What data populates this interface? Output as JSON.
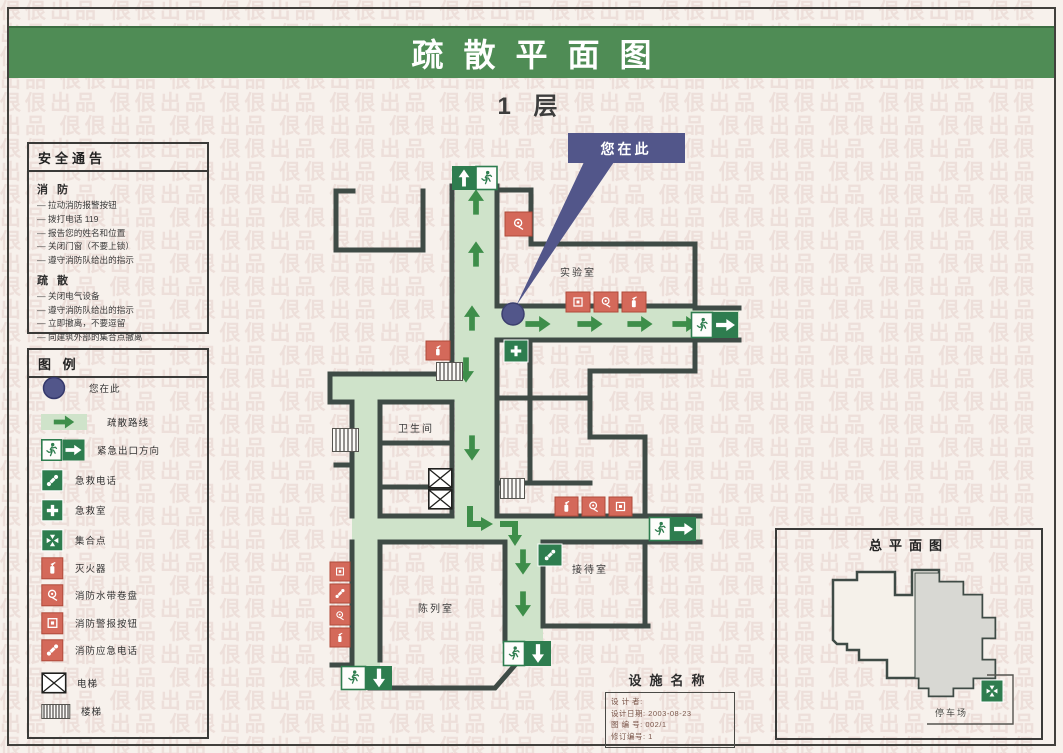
{
  "page": {
    "title": "疏散平面图",
    "floor": "1 层",
    "watermark_text": "佷佷出品"
  },
  "safety_notice": {
    "title": "安全通告",
    "sections": [
      {
        "heading": "消 防",
        "items": [
          "拉动消防报警按钮",
          "拨打电话 119",
          "报告您的姓名和位置",
          "关闭门窗（不要上锁）",
          "遵守消防队给出的指示"
        ]
      },
      {
        "heading": "疏 散",
        "items": [
          "关闭电气设备",
          "遵守消防队给出的指示",
          "立即撤离，不要逗留",
          "向建筑外部的集合点撤离"
        ]
      }
    ]
  },
  "legend": {
    "title": "图 例",
    "items": [
      {
        "icon": "you-are-here",
        "label": "您在此"
      },
      {
        "icon": "evacuation-route",
        "label": "疏散路线"
      },
      {
        "icon": "emergency-exit-direction",
        "label": "紧急出口方向"
      },
      {
        "icon": "first-aid-phone",
        "label": "急救电话"
      },
      {
        "icon": "first-aid-room",
        "label": "急救室"
      },
      {
        "icon": "assembly-point",
        "label": "集合点"
      },
      {
        "icon": "fire-extinguisher",
        "label": "灭火器"
      },
      {
        "icon": "fire-hose-reel",
        "label": "消防水带卷盘"
      },
      {
        "icon": "fire-alarm-button",
        "label": "消防警报按钮"
      },
      {
        "icon": "fire-emergency-phone",
        "label": "消防应急电话"
      },
      {
        "icon": "elevator",
        "label": "电梯"
      },
      {
        "icon": "stairs",
        "label": "楼梯"
      }
    ]
  },
  "map": {
    "callout": "您在此",
    "rooms": [
      {
        "name": "实验室"
      },
      {
        "name": "卫生间"
      },
      {
        "name": "接待室"
      },
      {
        "name": "陈列室"
      }
    ]
  },
  "site_plan": {
    "title": "总平面图",
    "parking_label": "停车场"
  },
  "facility": {
    "title": "设施名称",
    "info_lines": [
      "设 计 者:",
      "设计日期: 2003-08-23",
      "图 编 号: 002/1",
      "修订编号: 1"
    ]
  },
  "colors": {
    "header_green": "#4f8c55",
    "corridor_green": "#cfe3ca",
    "arrow_green": "#3e8e4a",
    "exit_green": "#2e7d4f",
    "fire_red": "#d4695a",
    "wall_dark": "#3f4b46",
    "callout_blue": "#52568a",
    "background": "#f7f1ec",
    "watermark_pink": "#d9b7b2"
  }
}
